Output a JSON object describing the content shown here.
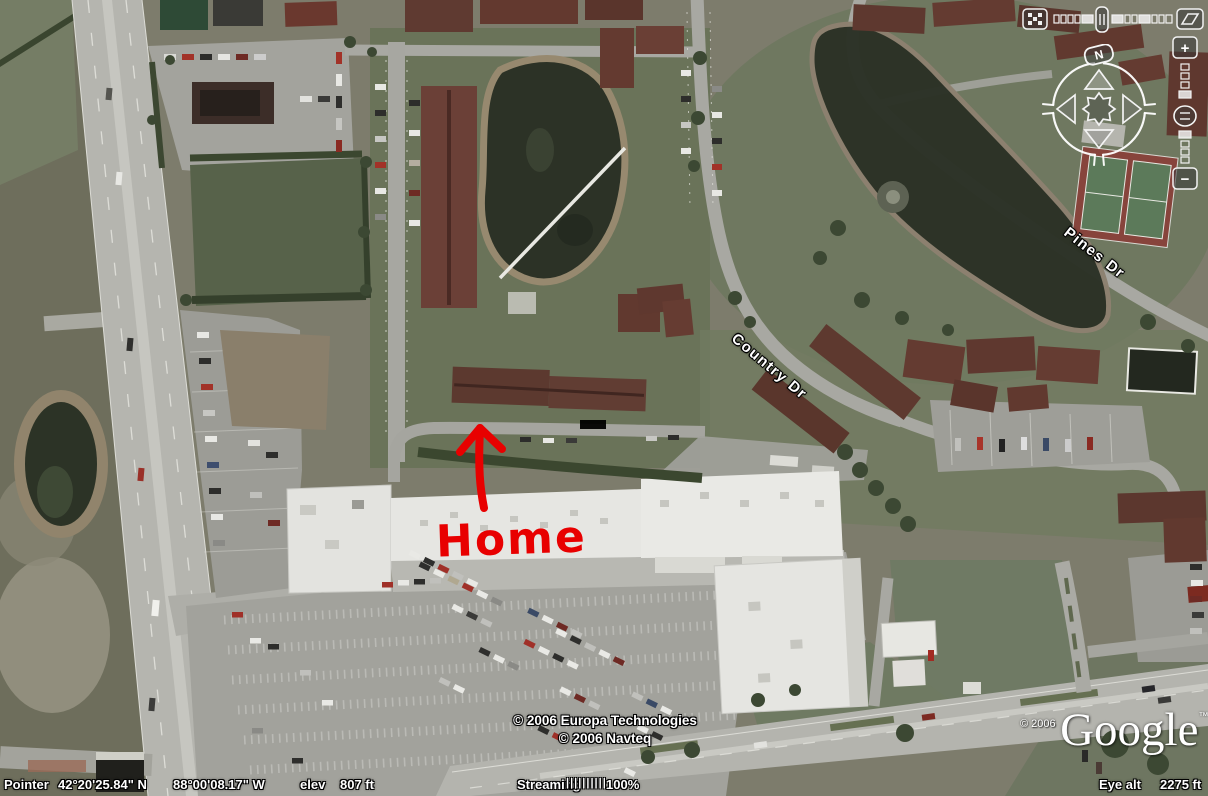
{
  "map": {
    "street_labels": [
      {
        "text": "Pines Dr"
      },
      {
        "text": "Country Dr"
      }
    ],
    "annotation": {
      "text": "Home"
    }
  },
  "credits": {
    "imagery_line1": "© 2006 Europa Technologies",
    "imagery_line2": "© 2006 Navteq",
    "logo_year": "© 2006",
    "logo_text": "Google",
    "logo_tm": "™"
  },
  "nav": {
    "north_label": "N",
    "zoom_in_label": "+",
    "zoom_out_label": "−"
  },
  "status_bar": {
    "pointer_label": "Pointer",
    "latitude": "42°20'25.84\" N",
    "longitude": "88°00'08.17\" W",
    "elevation_label": "elev",
    "elevation_value": "807 ft",
    "streaming_label": "Streaming",
    "streaming_gauge": "||||||||||",
    "streaming_value": "100%",
    "eye_alt_label": "Eye alt",
    "eye_alt_value": "2275 ft"
  },
  "colors": {
    "annotation_red": "#e80000",
    "water": "#2c3226",
    "roof_brown": "#5f382f",
    "road_gray": "#b5b5af",
    "mall_roof": "#e6e6e2",
    "grass": "#6a7359"
  }
}
